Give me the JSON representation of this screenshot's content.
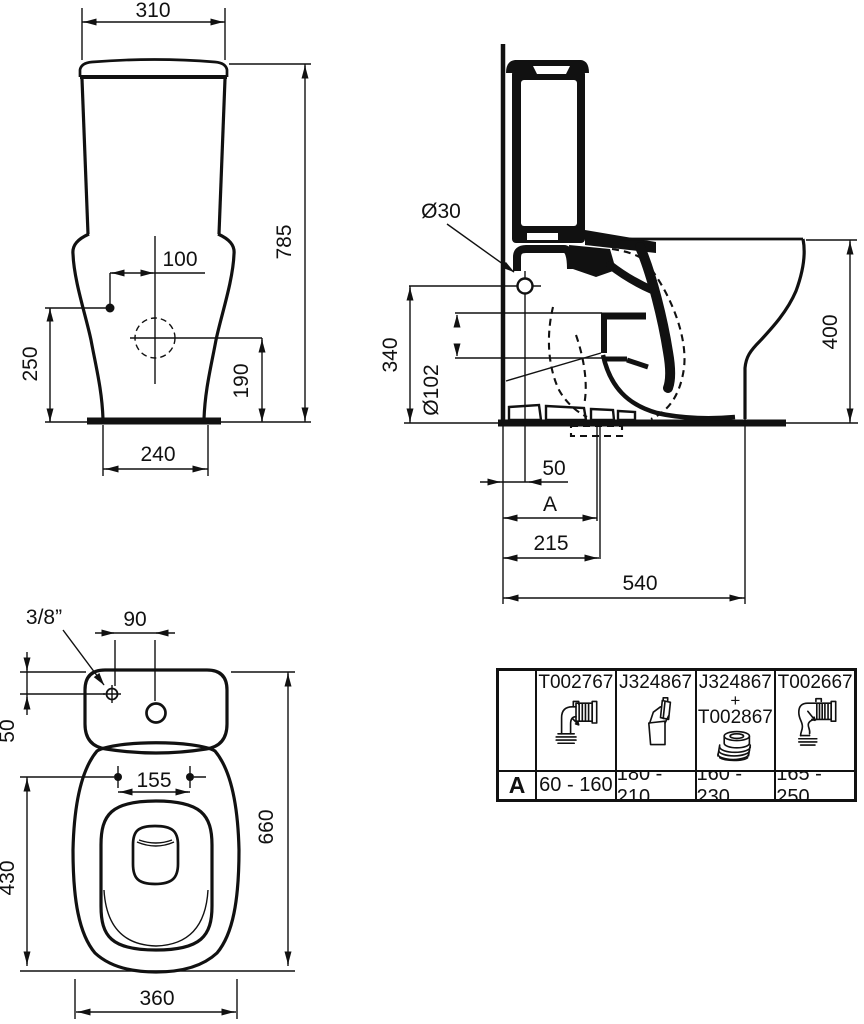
{
  "drawing": {
    "front_view": {
      "width_mm": "310",
      "overall_height_mm": "785",
      "inlet_offset_mm": "100",
      "inlet_height_mm": "250",
      "outlet_height_mm": "190",
      "base_width_mm": "240"
    },
    "side_view": {
      "fixing_hole_diameter": "Ø30",
      "fixing_hole_height_mm": "340",
      "outlet_diameter": "Ø102",
      "rim_height_mm": "400",
      "fixing_hole_offset_mm": "50",
      "outlet_distance_label": "A",
      "outlet_center_mm": "215",
      "base_depth_mm": "540"
    },
    "plan_view": {
      "water_inlet_size": "3/8”",
      "inlet_offset_mm": "90",
      "inlet_depth_mm": "50",
      "seat_hole_spacing_mm": "155",
      "seat_length_mm": "430",
      "overall_length_mm": "660",
      "bowl_width_mm": "360"
    },
    "accessories_table": {
      "row_label": "A",
      "columns": [
        {
          "part": "T002767",
          "range": "60 - 160",
          "icon": "elbow-flexible-connector-icon"
        },
        {
          "part": "J324867",
          "range": "180 - 210",
          "icon": "angled-connector-icon"
        },
        {
          "part_lines": [
            "J324867",
            "+",
            "T002867"
          ],
          "range": "160 - 230",
          "icon": "eccentric-ring-connector-icon"
        },
        {
          "part": "T002667",
          "range": "165 - 250",
          "icon": "s-bend-flexible-connector-icon"
        }
      ]
    }
  }
}
